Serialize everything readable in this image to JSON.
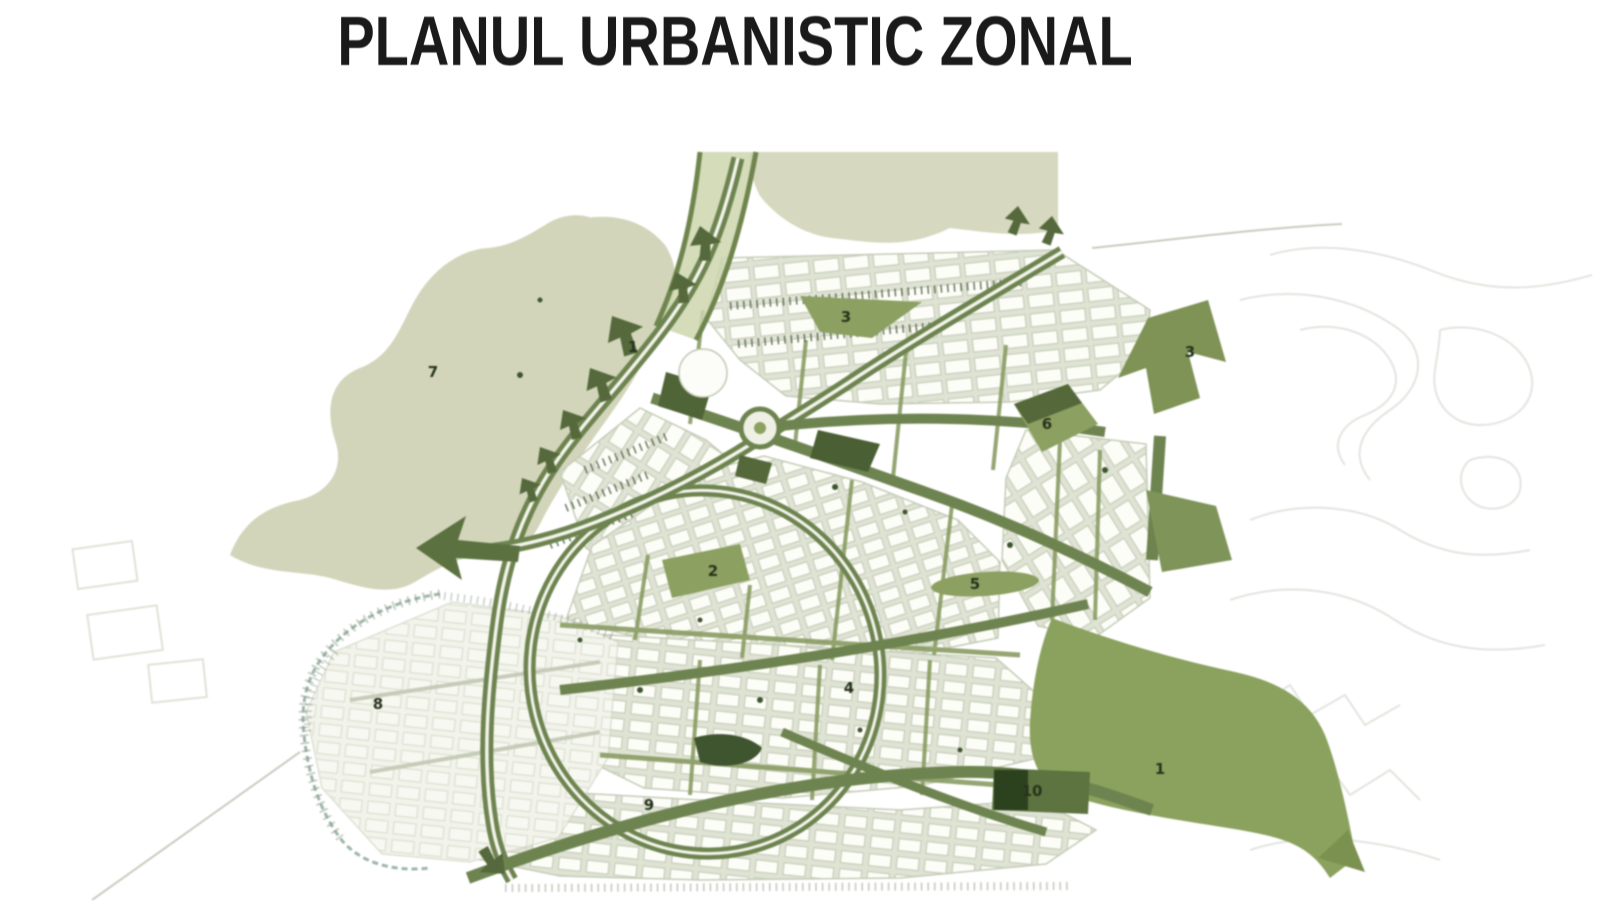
{
  "page": {
    "title": "PLANUL URBANISTIC ZONAL",
    "background": "#ffffff"
  },
  "map": {
    "colors": {
      "title_text": "#1a1a1a",
      "road_green": "#6e8450",
      "park_green": "#8ca061",
      "solid_green_area": "#8ba25e",
      "dark_green": "#42552f",
      "sage_area": "#d2d5ba",
      "block_fill": "#fdfdf8",
      "block_street": "#dfe3d4",
      "block_outline": "#c5ccb8",
      "contour_gray": "#e3e5df",
      "boundary_teal": "#9db6aa"
    },
    "labels": [
      {
        "text": "7",
        "x": 433,
        "y": 377
      },
      {
        "text": "1",
        "x": 633,
        "y": 352
      },
      {
        "text": "3",
        "x": 846,
        "y": 322
      },
      {
        "text": "3",
        "x": 1190,
        "y": 357
      },
      {
        "text": "6",
        "x": 1047,
        "y": 429
      },
      {
        "text": "2",
        "x": 713,
        "y": 576
      },
      {
        "text": "5",
        "x": 975,
        "y": 589
      },
      {
        "text": "4",
        "x": 849,
        "y": 693
      },
      {
        "text": "8",
        "x": 378,
        "y": 709
      },
      {
        "text": "9",
        "x": 649,
        "y": 810
      },
      {
        "text": "10",
        "x": 1032,
        "y": 796
      },
      {
        "text": "1",
        "x": 1160,
        "y": 774
      }
    ]
  }
}
